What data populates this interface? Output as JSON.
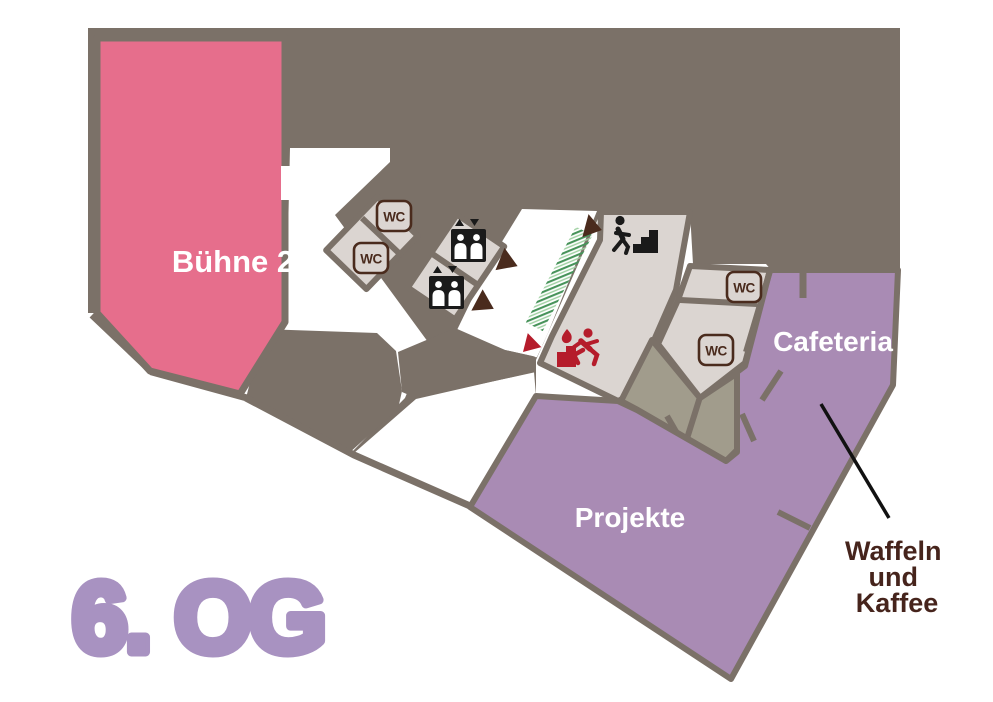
{
  "floor_plan": {
    "floor_label": "6. OG",
    "rooms": [
      {
        "id": "buehne2",
        "label": "Bühne 2",
        "color": "#e66e8c",
        "text_color": "#ffffff"
      },
      {
        "id": "projekte",
        "label": "Projekte",
        "color": "#a98bb4",
        "text_color": "#ffffff"
      },
      {
        "id": "cafeteria",
        "label": "Cafeteria",
        "color": "#a98bb4",
        "text_color": "#ffffff"
      }
    ],
    "wc_icon_label": "WC",
    "annotation": {
      "line1": "Waffeln",
      "line2": "und",
      "line3": "Kaffee",
      "color": "#46241c",
      "target": "cafeteria"
    },
    "icons": [
      {
        "name": "wc-icon",
        "count": 4
      },
      {
        "name": "elevator-icon",
        "count": 2
      },
      {
        "name": "stairs-icon",
        "count": 1
      },
      {
        "name": "emergency-exit-icon",
        "count": 1
      },
      {
        "name": "direction-arrow-brown",
        "count": 3
      },
      {
        "name": "direction-arrow-red",
        "count": 1
      },
      {
        "name": "greenery-strip",
        "count": 1
      }
    ],
    "colors": {
      "wall": "#7b7168",
      "room_light": "#dbd5d1",
      "room_olive": "#a19c8c",
      "pink": "#e66e8c",
      "purple": "#a98bb4",
      "floor_label_purple": "#a892c1",
      "icon_brown": "#4a2b1d",
      "emergency_red": "#b51c2b",
      "stairs_black": "#1a1a1a",
      "greenery_green": "#47935a",
      "annotation_text": "#46241c"
    }
  }
}
